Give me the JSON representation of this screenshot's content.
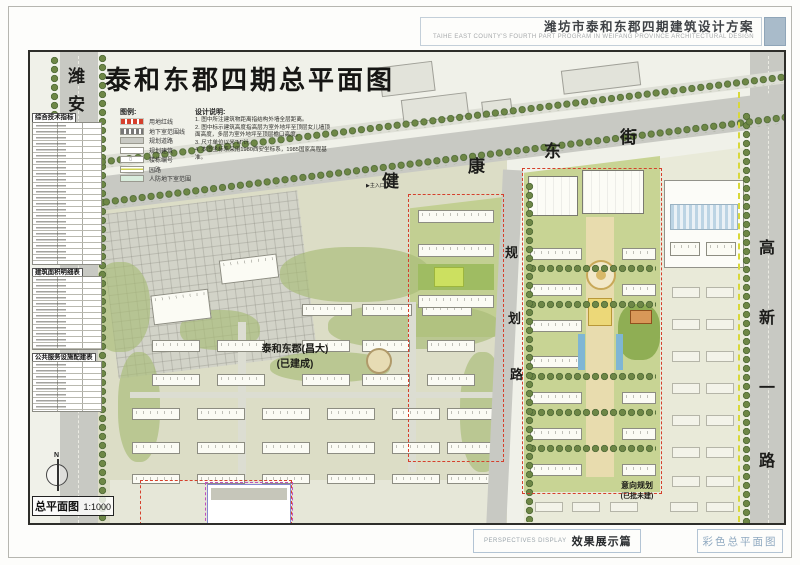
{
  "header": {
    "title_cn": "潍坊市泰和东郡四期建筑设计方案",
    "title_en": "TAIHE EAST COUNTY'S FOURTH PART PROGRAM IN WEIFANG PROVINCE   ARCHITECTURAL DESIGN"
  },
  "drawing": {
    "title": "泰和东郡四期总平面图",
    "legend": {
      "heading": "图例:",
      "items": [
        {
          "label": "用地红线",
          "swatch": "red-dash"
        },
        {
          "label": "地下室范围线",
          "swatch": "grey-dash"
        },
        {
          "label": "规划道路",
          "swatch": "road"
        },
        {
          "label": "规划建筑",
          "swatch": "building"
        },
        {
          "label": "楼栋编号",
          "swatch": "number"
        },
        {
          "label": "园路",
          "swatch": "path"
        },
        {
          "label": "人防地下室范围",
          "swatch": "basement"
        }
      ]
    },
    "notes": {
      "heading": "设计说明:",
      "items": [
        "1. 图中所注建筑物距离指结构外墙全层距离。",
        "2. 图中标示建筑高度指高层为室外地坪至顶层女儿墙顶面高度，多层为室外地坪至顶层檐口高度。",
        "3. 尺寸单位以米\"M\"计。",
        "4. 本图坐标系采用1980西安坐标系，1985国家高程基准。"
      ]
    },
    "roads": {
      "west": "潍安路",
      "north": "健康东街",
      "middle": "规划路",
      "east": "高新一路"
    },
    "labels": {
      "built_site_line1": "泰和东郡(昌大)",
      "built_site_line2": "(已建成)",
      "planned_site_line1": "意向规划",
      "planned_site_line2": "(已批未建)",
      "main_entrance": "主入口"
    },
    "tables": {
      "t1_title": "综合技术指标",
      "t2_title": "建筑面积明细表",
      "t3_title": "公共服务设施配建表"
    },
    "scale_label": "总平面图",
    "scale_value": "1:1000",
    "north_label": "N"
  },
  "footer": {
    "section_en": "PERSPECTIVES DISPLAY",
    "section_cn": "效果展示篇",
    "page_title": "彩色总平面图"
  }
}
